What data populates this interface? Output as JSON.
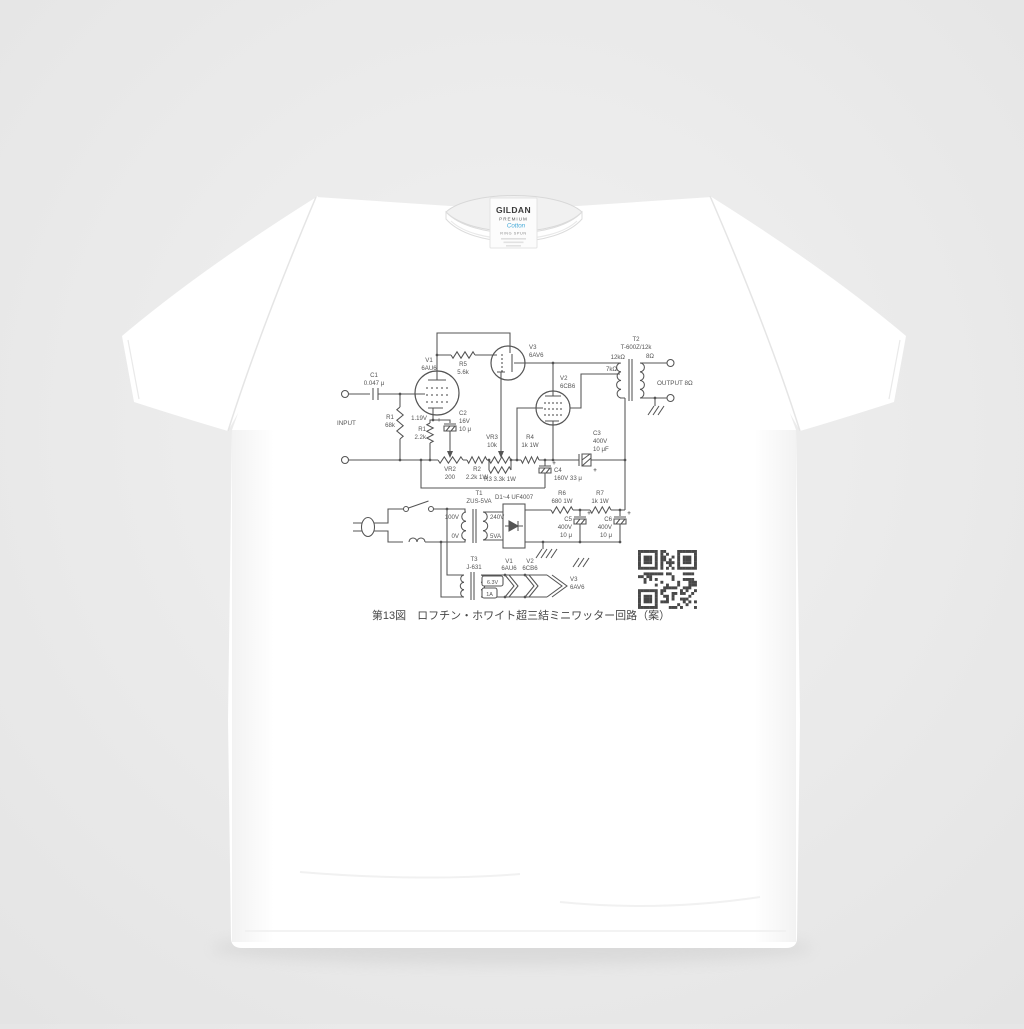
{
  "product": {
    "background_color": "#eaeaea",
    "shirt_color": "#ffffff",
    "ink_color": "#4a4a4a"
  },
  "neck_label": {
    "brand": "GILDAN",
    "line": "PREMIUM",
    "sub": "Cotton",
    "spun": "RING SPUN"
  },
  "print": {
    "caption": "第13図　ロフチン・ホワイト超三結ミニワッター回路（案）",
    "s": {
      "input": "INPUT",
      "output": "OUTPUT 8Ω",
      "c1": "C1",
      "c1v": "0.047 μ",
      "r1": "R1",
      "r1v": "68k",
      "v1": "V1",
      "v1v": "6AU6",
      "bias": "1.19V",
      "rk": "R1",
      "rkv": "2.2k",
      "c2": "C2",
      "c2a": "16V",
      "c2b": "10 μ",
      "r5": "R5",
      "r5v": "5.6k",
      "v3": "V3",
      "v3v": "6AV6",
      "v2": "V2",
      "v2v": "6CB6",
      "t2": "T2",
      "t2v": "T-600Z/12k",
      "tap12": "12kΩ",
      "tap7": "7kΩ",
      "sec8": "8Ω",
      "vr2": "VR2",
      "vr2v": "200",
      "r2": "R2",
      "r2v": "2.2k 1W",
      "vr3": "VR3",
      "vr3v": "10k",
      "r3": "R3 3.3k 1W",
      "r4": "R4",
      "r4v": "1k 1W",
      "c3": "C3",
      "c3a": "400V",
      "c3b": "10 μF",
      "c4": "C4",
      "c4v": "160V 33 μ",
      "t1": "T1",
      "t1v": "ZUS-5VA",
      "p100": "100V",
      "p0": "0V",
      "s240": "240V",
      "s5va": "5VA",
      "d": "D1~4 UF4007",
      "r6": "R6",
      "r6v": "680 1W",
      "r7": "R7",
      "r7v": "1k 1W",
      "c5": "C5",
      "c5a": "400V",
      "c5b": "10 μ",
      "c6": "C6",
      "c6a": "400V",
      "c6b": "10 μ",
      "t3": "T3",
      "t3v": "J-631",
      "h63": "6.3V",
      "h1a": "1A",
      "hv1": "V1",
      "hv1v": "6AU6",
      "hv2": "V2",
      "hv2v": "6CB6",
      "hv3": "V3",
      "hv3v": "6AV6",
      "plus": "+"
    }
  }
}
